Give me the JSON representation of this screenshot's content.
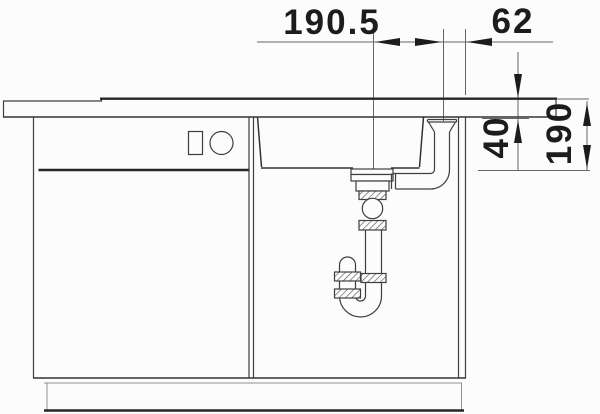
{
  "diagram": {
    "description": "technical line drawing of a kitchen sink cabinet cross-section with strainer, overflow pipe and siphon trap",
    "dim_labels": {
      "h_span": "190.5",
      "h_offset": "62",
      "v_depth": "40",
      "v_height": "190"
    },
    "colors": {
      "background": "#fcfcfc",
      "line_main": "#3f3f3f",
      "line_bold": "#262626",
      "line_dim": "#666666",
      "text": "#1c1c1c"
    }
  }
}
